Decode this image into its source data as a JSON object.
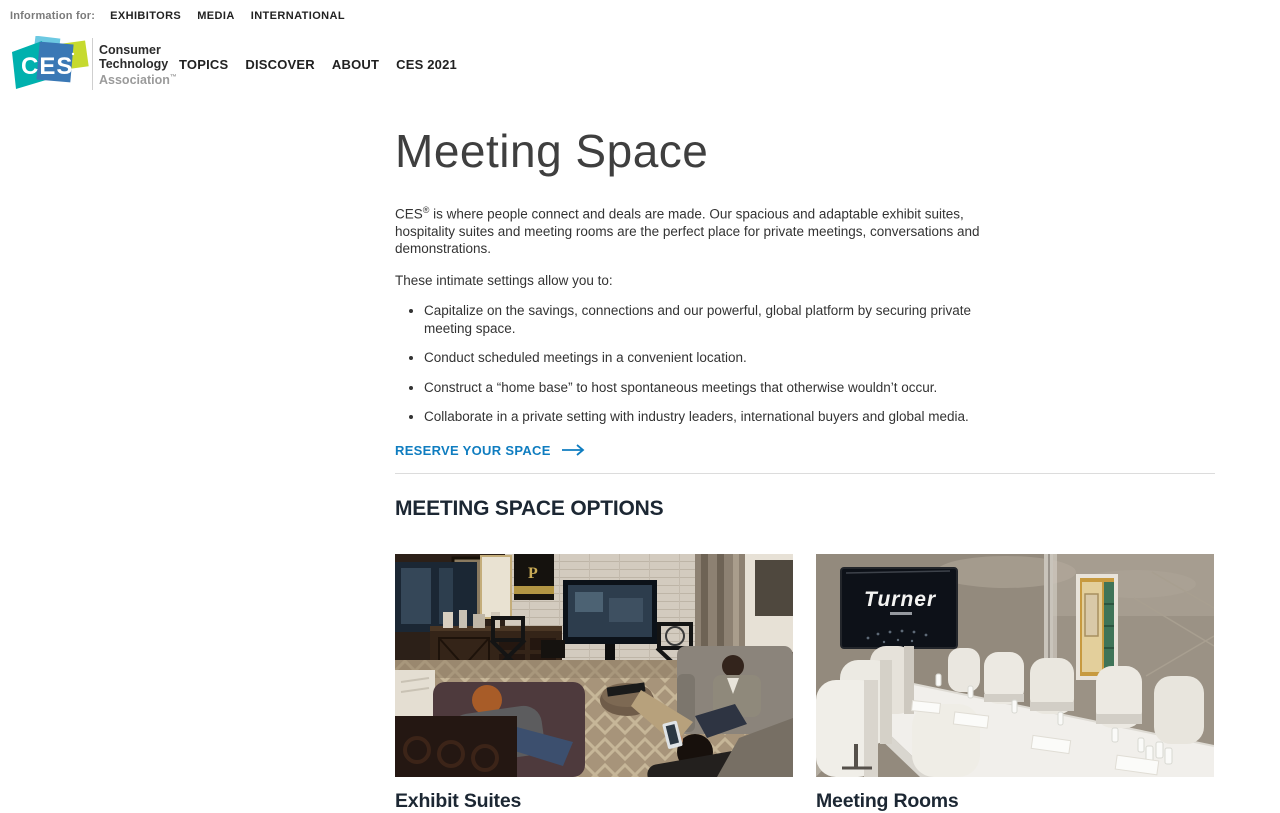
{
  "topbar": {
    "label": "Information for:",
    "links": [
      {
        "label": "EXHIBITORS"
      },
      {
        "label": "MEDIA"
      },
      {
        "label": "INTERNATIONAL"
      }
    ]
  },
  "header": {
    "logo_text": "CES",
    "org": {
      "line1": "Consumer",
      "line2": "Technology",
      "line3": "Association",
      "tm": "™"
    },
    "nav": [
      {
        "label": "TOPICS"
      },
      {
        "label": "DISCOVER"
      },
      {
        "label": "ABOUT"
      },
      {
        "label": "CES 2021"
      }
    ]
  },
  "main": {
    "title": "Meeting Space",
    "intro": {
      "brand": "CES",
      "sup": "®",
      "text": " is where people connect and deals are made. Our spacious and adaptable exhibit suites, hospitality suites and meeting rooms are the perfect place for private meetings, conversations and demonstrations."
    },
    "lead_in": "These intimate settings allow you to:",
    "bullets": [
      "Capitalize on the savings, connections and our powerful, global platform by securing private meeting space.",
      "Conduct scheduled meetings in a convenient location.",
      "Construct a “home base” to host spontaneous meetings that otherwise wouldn’t occur.",
      "Collaborate in a private setting with industry leaders, international buyers and global media.",
      ""
    ],
    "cta": {
      "label": "RESERVE YOUR SPACE"
    },
    "section_heading": "MEETING SPACE OPTIONS",
    "cards": [
      {
        "title": "Exhibit Suites",
        "plaque_text": "P"
      },
      {
        "title": "Meeting Rooms",
        "screen_text": "Turner"
      }
    ]
  },
  "icons": {
    "cta_arrow": "arrow-right"
  },
  "colors": {
    "link_blue": "#0f7dc0",
    "logo_teal": "#00b1ae",
    "logo_blue": "#3a78b5",
    "logo_lime": "#c6da2f",
    "logo_cyan": "#6cc9e2",
    "divider": "#dcdcdc",
    "heading_dark": "#1c2733"
  }
}
